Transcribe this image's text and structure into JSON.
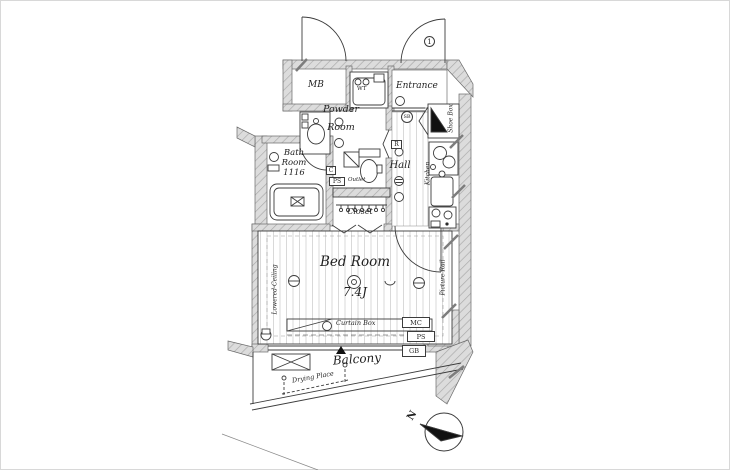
{
  "floorplan": {
    "rooms": {
      "mb": "MB",
      "entrance": "Entrance",
      "powder_line1": "Powder",
      "powder_line2": "Room",
      "bath_line1": "Bath",
      "bath_line2": "Room",
      "bath_size": "1116",
      "hall": "Hall",
      "closet": "Closet",
      "bed_room": "Bed Room",
      "bed_size": "7.4J",
      "balcony": "Balcony"
    },
    "labels": {
      "outlet": "Outlet",
      "curtain_box": "Curtain Box",
      "drying_place": "Drying Place",
      "shoe_box": "Shoe Box",
      "kitchen": "Kitchen",
      "lowered_ceiling": "Lowered-Ceiling",
      "picture_rail": "Picture Rail",
      "washer_tray": "WT",
      "switch_box": "SB",
      "unit_number": "1",
      "compass_north": "N"
    },
    "service_boxes": {
      "r": "R",
      "c": "C",
      "ps_upper": "PS",
      "mc": "MC",
      "ps_lower": "PS",
      "gb": "GB"
    },
    "colors": {
      "wall_fill": "#dcdcdc",
      "wall_hatch": "#a8a8a8",
      "line": "#3c3c3c",
      "floor_stripe": "#d9d9d9",
      "paper": "#ffffff"
    }
  }
}
